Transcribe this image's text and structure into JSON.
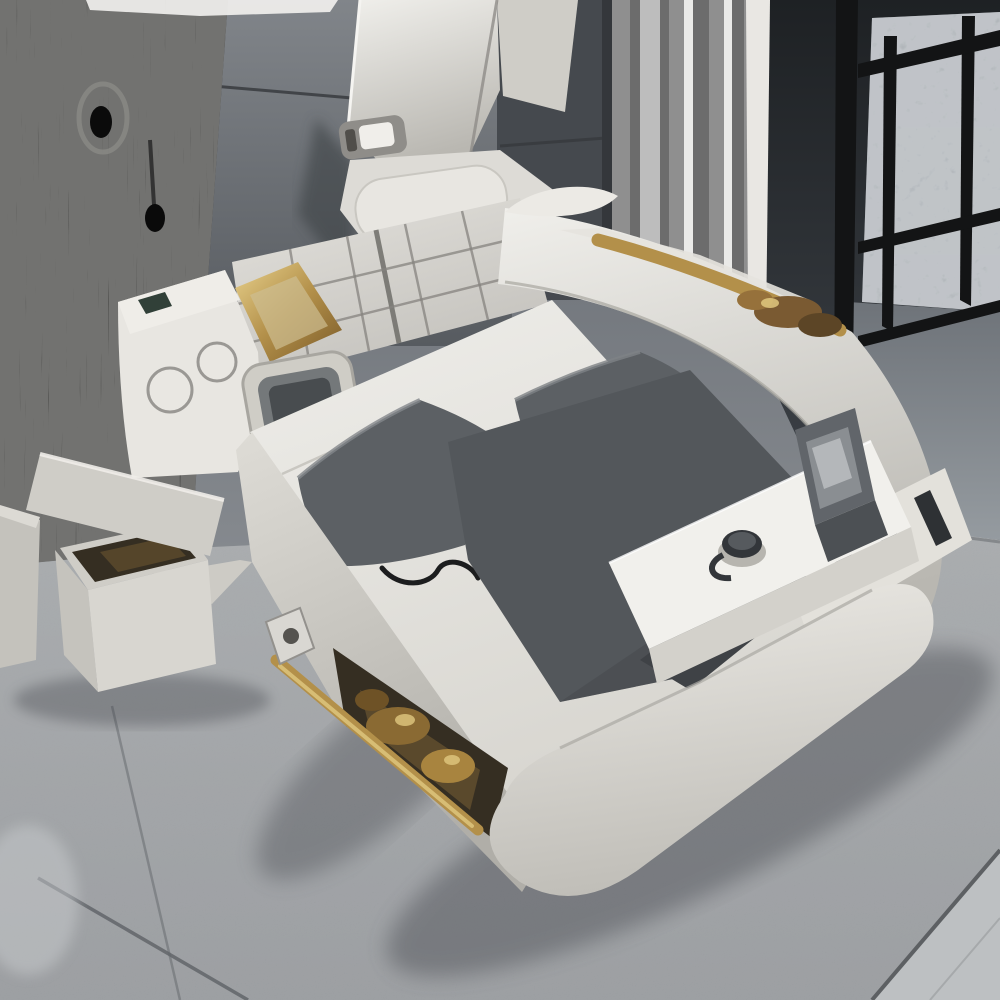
{
  "meta": {
    "caption": "Gray multifunctional smart bed with massage-chair backrest, tufted headboard, built-in speaker console, fold-out screen, laptop tray with cup, open storage ottoman and gold accents, in a bedroom with a black wood-grain panel, paneled gray wall, striped curtain, balcony railing and gray carpet"
  },
  "scene": {
    "background": {
      "left_panel": "black wood-grain wall panel with knot",
      "wall": "dark gray paneled wall with seams",
      "curtain": "gray vertically striped curtain",
      "balcony": "dark glass door, white frame post, stone pillar, black metal railing, concrete floor",
      "floor": "gray carpet with seams and light tile corner"
    },
    "bed": {
      "type": "multifunctional smart bed",
      "features": [
        "tall massage-chair backrest with handle slot",
        "headrest cushion",
        "checkered tufted headboard",
        "left console with two round speakers and fold-out screen",
        "gold diamond trim panel",
        "white mattress with two dark gray pillows and dark runner",
        "open under-bed storage with gold items and gold rail",
        "right armrest with gold trim",
        "foot tray with cup and open laptop",
        "slatted shelf under tray",
        "rounded footboard"
      ]
    },
    "ottoman": "open storage ottoman with tilted lid and dark interior",
    "extra": "second gray storage box at left edge"
  },
  "palette": {
    "wood_black": "#161616",
    "wall_band": "#5f6368",
    "wall_dark_band": "#45494e",
    "wall_seam": "#34373b",
    "curtain_base": "#8f8f8f",
    "curtain_dark": "#6c6c6c",
    "curtain_light": "#bdbdbd",
    "curtain_white": "#eaeae8",
    "door_frame": "#e9e7e3",
    "glass_dark": "#2a2d31",
    "railing_black": "#131415",
    "stone_gray": "#9da3a8",
    "concrete_gray": "#81878d",
    "carpet_gray": "#9fa2a5",
    "carpet_seam": "#62656a",
    "tile_light": "#bdc0c2",
    "bed_white": "#e8e6e1",
    "bed_shade": "#cfcdc7",
    "bed_deep": "#b2b0aa",
    "tray_white": "#f1f0ec",
    "tuft_gray": "#d8d6d1",
    "tuft_line": "#85837f",
    "pillow_gray": "#5c6064",
    "runner_gray": "#53575b",
    "gold": "#b3904a",
    "gold_light": "#e0c87f",
    "bronze": "#6f5429",
    "chrome": "#d9d7d2",
    "screen_frame": "#cfcdc6",
    "screen_dark": "#484c4f",
    "teal": "#314038",
    "cup": "#33363a",
    "laptop": "#61656a",
    "laptop_screen": "#8a8e92",
    "cable": "#1c1d1e",
    "slat_dark": "#2e3134",
    "interior_dark": "#352e22",
    "interior_warm": "#6b5530",
    "shadow": "#40434a"
  }
}
